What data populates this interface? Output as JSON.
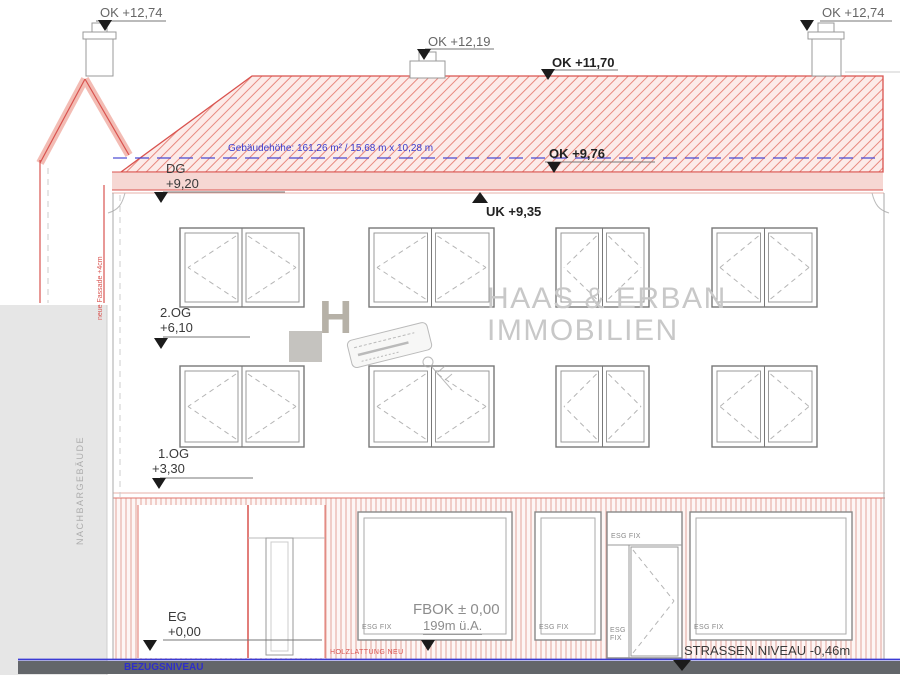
{
  "labels": {
    "chimney_left_ok": "OK +12,74",
    "chimney_right_ok": "OK +12,74",
    "vent_ok": "OK +12,19",
    "ridge_ok": "OK +11,70",
    "eaves_ok": "OK +9,76",
    "eaves_uk": "UK +9,35",
    "building_height_note": "Gebäudehöhe: 161,26 m² / 15,68 m x 10,28 m",
    "floor_dg": "DG",
    "floor_dg_level": "+9,20",
    "floor_og2": "2.OG",
    "floor_og2_level": "+6,10",
    "floor_og1": "1.OG",
    "floor_og1_level": "+3,30",
    "floor_eg": "EG",
    "floor_eg_level": "+0,00",
    "fbok_line1": "FBOK ± 0,00",
    "fbok_line2": "199m ü.A.",
    "glass_label": "ESG FIX",
    "street_level": "STRASSEN NIVEAU -0,46m",
    "datum_level": "BEZUGSNIVEAU",
    "cladding_note": "HOLZLATTUNG NEU",
    "neighbor_label": "NACHBARGEBÄUDE",
    "facade_note": "neue Fassade +4cm"
  },
  "watermark": {
    "logo_letter": "H",
    "brand_line1": "HAAS & ERBAN",
    "brand_line2": "IMMOBILIEN"
  },
  "colors": {
    "roof_red": "#d9534f",
    "roof_fill": "#fcebe9",
    "annotation_blue": "#3c3ccc",
    "ground_gray": "#63666a",
    "neighbor_gray": "#e6e6e6",
    "watermark_gray": "#c8c8c8"
  }
}
